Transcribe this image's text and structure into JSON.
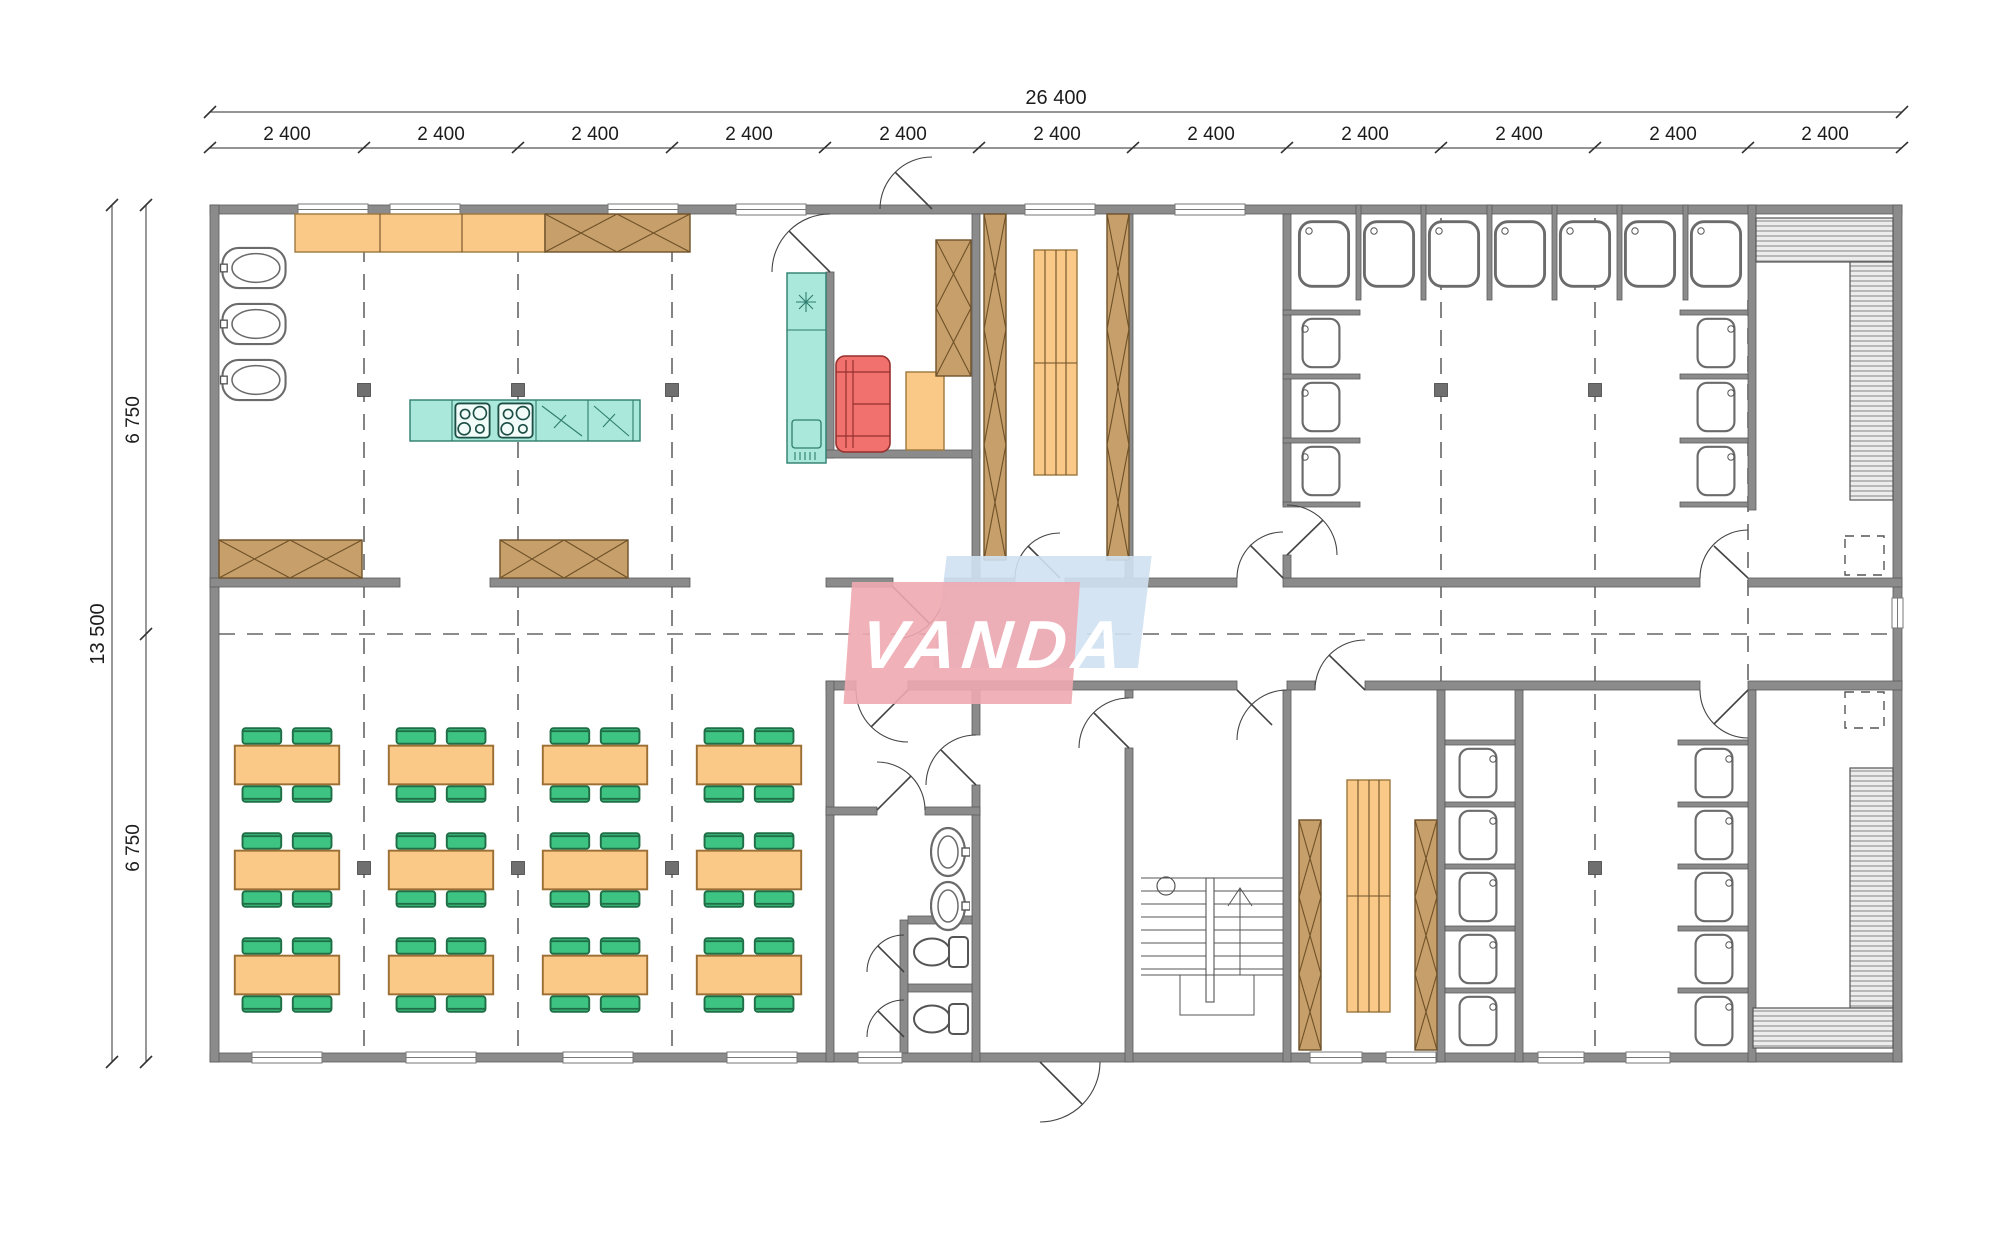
{
  "drawing": {
    "type": "architectural-floor-plan",
    "description": "Modular canteen building plan with kitchen, dining hall, cloakrooms, showers, WCs and staircase"
  },
  "dimensions": {
    "total_width_label": "26 400",
    "bay_width_label": "2 400",
    "bay_count": 11,
    "total_height_label": "13 500",
    "upper_half_label": "6 750",
    "lower_half_label": "6 750"
  },
  "watermark": {
    "text": "VANDA",
    "pink_color": "#f0a9b0",
    "blue_color": "#cfe1f2",
    "text_color": "#ffffff"
  },
  "palette": {
    "wall_gray": "#8b8b8b",
    "furniture_orange": "#fac887",
    "cabinet_brown": "#c79f6a",
    "kitchen_teal": "#a9e8da",
    "sofa_red": "#f0716d",
    "chair_green": "#3ec482",
    "fixture_white": "#ffffff",
    "line_gray": "#555555"
  }
}
